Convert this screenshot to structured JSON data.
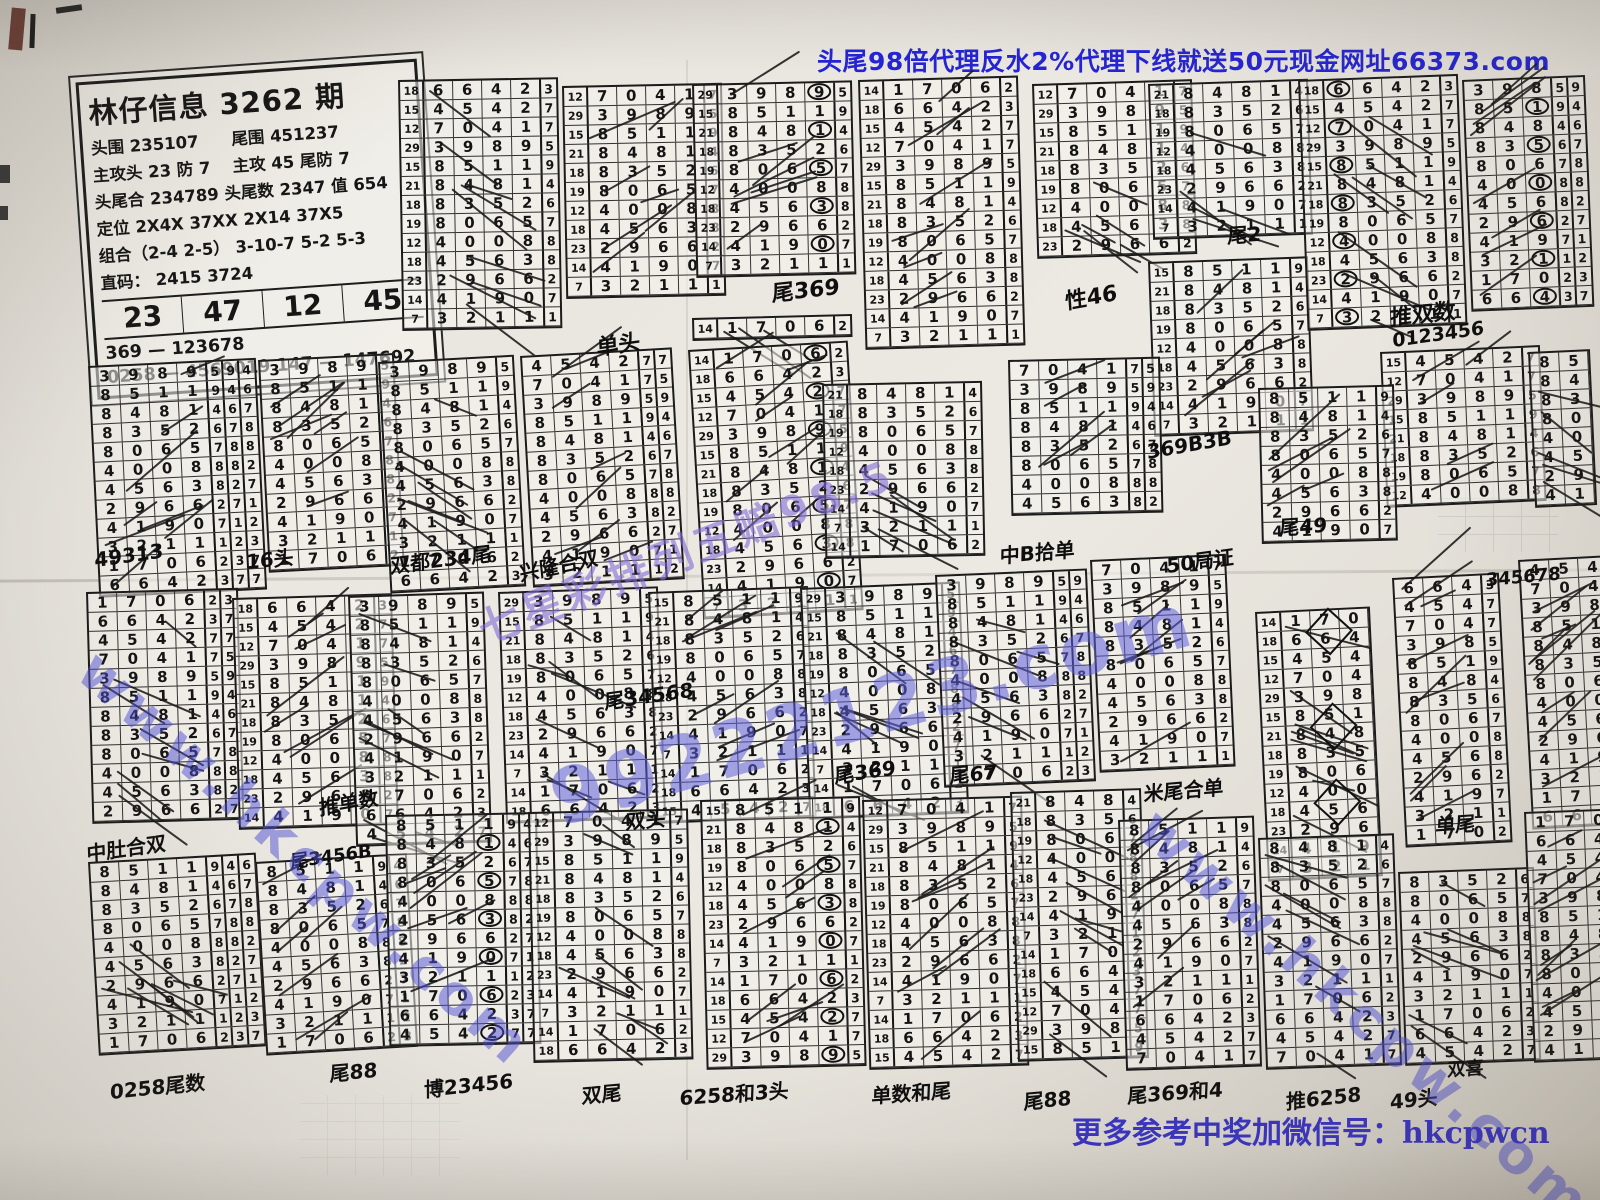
{
  "banner_top": {
    "text": "头尾98倍代理反水2%代理下线就送50元现金网址66373.com",
    "color": "#2424d6"
  },
  "banner_bottom": {
    "text": "更多参考中奖加微信号：hkcpwcn",
    "color": "#3a34c6"
  },
  "info_box": {
    "title": "林仔信息 3262 期",
    "lines": [
      "头围 235107　　尾围 451237",
      "主攻头 23 防 7　 主攻 45 尾防 7",
      "头尾合 234789 头尾数 2347  值 654",
      "定位 2X4X  37XX  2X14  37X5",
      "组合（2-4 2-5）  3-10-7  5-2 5-3",
      "直码： 2415  3724"
    ],
    "highlight_numbers": [
      "23",
      "47",
      "12",
      "45"
    ],
    "footer_lines": [
      "369 — 123678",
      "0258 — 4569019  147 — 147692"
    ]
  },
  "cycle": {
    "labels": [
      "14",
      "18",
      "15",
      "12",
      "29",
      "15",
      "21",
      "18",
      "19",
      "12",
      "18",
      "23",
      "14",
      "7"
    ],
    "digits": [
      "1706",
      "6642",
      "4542",
      "7041",
      "3989",
      "8511",
      "8481",
      "8352",
      "8065",
      "4008",
      "4563",
      "2966",
      "4190",
      "3211"
    ],
    "rights": [
      "2",
      "3",
      "7",
      "7",
      "5",
      "9",
      "4",
      "6",
      "7",
      "8",
      "8",
      "2",
      "7",
      "1"
    ]
  },
  "blocks": [
    {
      "x": 398,
      "y": 80,
      "s": 1,
      "r": 13,
      "lab": 1,
      "c": 4,
      "e": 1
    },
    {
      "x": 562,
      "y": 86,
      "s": 3,
      "r": 11,
      "lab": 1,
      "c": 4,
      "e": 1
    },
    {
      "x": 692,
      "y": 84,
      "s": 4,
      "r": 10,
      "lab": 1,
      "c": 4,
      "e": 1,
      "circle": 3
    },
    {
      "x": 692,
      "y": 318,
      "s": 0,
      "r": 1,
      "lab": 1,
      "c": 4,
      "e": 1
    },
    {
      "x": 858,
      "y": 80,
      "s": 0,
      "r": 14,
      "lab": 1,
      "c": 4,
      "e": 1
    },
    {
      "x": 1032,
      "y": 84,
      "s": 3,
      "r": 9,
      "lab": 1,
      "c": 4,
      "e": 1
    },
    {
      "x": 1148,
      "y": 84,
      "s": 6,
      "r": 8,
      "lab": 1,
      "c": 4,
      "e": 1
    },
    {
      "x": 1148,
      "y": 262,
      "s": 5,
      "r": 9,
      "lab": 1,
      "c": 4,
      "e": 1
    },
    {
      "x": 1298,
      "y": 80,
      "s": 1,
      "r": 13,
      "lab": 1,
      "c": 4,
      "e": 1,
      "circle": 0
    },
    {
      "x": 1462,
      "y": 80,
      "s": 4,
      "r": 12,
      "lab": 0,
      "c": 3,
      "e": 2,
      "circle": 2
    },
    {
      "x": 1380,
      "y": 352,
      "s": 2,
      "r": 8,
      "lab": 1,
      "c": 4,
      "e": 1
    },
    {
      "x": 1528,
      "y": 352,
      "s": 5,
      "r": 8,
      "lab": 0,
      "c": 2,
      "e": 0
    },
    {
      "x": 88,
      "y": 366,
      "s": 4,
      "r": 12,
      "lab": 0,
      "c": 4,
      "e": 3
    },
    {
      "x": 258,
      "y": 360,
      "s": 4,
      "r": 11,
      "lab": 0,
      "c": 4,
      "e": 1
    },
    {
      "x": 378,
      "y": 362,
      "s": 4,
      "r": 12,
      "lab": 0,
      "c": 4,
      "e": 1
    },
    {
      "x": 520,
      "y": 356,
      "s": 2,
      "r": 12,
      "lab": 0,
      "c": 4,
      "e": 2
    },
    {
      "x": 688,
      "y": 350,
      "s": 0,
      "r": 14,
      "lab": 1,
      "c": 4,
      "e": 1,
      "circle": 3
    },
    {
      "x": 822,
      "y": 384,
      "s": 6,
      "r": 9,
      "lab": 1,
      "c": 4,
      "e": 1
    },
    {
      "x": 1008,
      "y": 360,
      "s": 3,
      "r": 8,
      "lab": 0,
      "c": 4,
      "e": 2
    },
    {
      "x": 1258,
      "y": 388,
      "s": 5,
      "r": 8,
      "lab": 0,
      "c": 4,
      "e": 1
    },
    {
      "x": 86,
      "y": 592,
      "s": 0,
      "r": 12,
      "lab": 0,
      "c": 4,
      "e": 2
    },
    {
      "x": 232,
      "y": 598,
      "s": 1,
      "r": 12,
      "lab": 1,
      "c": 4,
      "e": 1
    },
    {
      "x": 348,
      "y": 596,
      "s": 4,
      "r": 13,
      "lab": 0,
      "c": 4,
      "e": 1
    },
    {
      "x": 498,
      "y": 592,
      "s": 4,
      "r": 12,
      "lab": 1,
      "c": 4,
      "e": 1
    },
    {
      "x": 648,
      "y": 592,
      "s": 5,
      "r": 12,
      "lab": 1,
      "c": 4,
      "e": 1
    },
    {
      "x": 800,
      "y": 588,
      "s": 4,
      "r": 12,
      "lab": 1,
      "c": 4,
      "e": 1
    },
    {
      "x": 935,
      "y": 575,
      "s": 4,
      "r": 11,
      "lab": 0,
      "c": 4,
      "e": 2
    },
    {
      "x": 1090,
      "y": 560,
      "s": 3,
      "r": 11,
      "lab": 0,
      "c": 4,
      "e": 1
    },
    {
      "x": 1255,
      "y": 612,
      "s": 0,
      "r": 14,
      "lab": 1,
      "c": 3,
      "e": 0,
      "diamond": 1
    },
    {
      "x": 1392,
      "y": 578,
      "s": 1,
      "r": 14,
      "lab": 0,
      "c": 3,
      "e": 1
    },
    {
      "x": 1518,
      "y": 560,
      "s": 2,
      "r": 14,
      "lab": 0,
      "c": 3,
      "e": 0
    },
    {
      "x": 88,
      "y": 862,
      "s": 5,
      "r": 10,
      "lab": 0,
      "c": 4,
      "e": 3
    },
    {
      "x": 255,
      "y": 862,
      "s": 5,
      "r": 10,
      "lab": 0,
      "c": 4,
      "e": 2
    },
    {
      "x": 385,
      "y": 815,
      "s": 5,
      "r": 12,
      "lab": 0,
      "c": 4,
      "e": 2,
      "circle": 3
    },
    {
      "x": 528,
      "y": 812,
      "s": 3,
      "r": 13,
      "lab": 1,
      "c": 4,
      "e": 1
    },
    {
      "x": 700,
      "y": 800,
      "s": 5,
      "r": 14,
      "lab": 1,
      "c": 4,
      "e": 1,
      "circle": 3
    },
    {
      "x": 862,
      "y": 800,
      "s": 3,
      "r": 14,
      "lab": 1,
      "c": 4,
      "e": 1
    },
    {
      "x": 1010,
      "y": 792,
      "s": 6,
      "r": 14,
      "lab": 1,
      "c": 3,
      "e": 1
    },
    {
      "x": 1118,
      "y": 820,
      "s": 5,
      "r": 13,
      "lab": 0,
      "c": 4,
      "e": 1
    },
    {
      "x": 1258,
      "y": 838,
      "s": 6,
      "r": 12,
      "lab": 0,
      "c": 4,
      "e": 1
    },
    {
      "x": 1398,
      "y": 872,
      "s": 7,
      "r": 10,
      "lab": 0,
      "c": 4,
      "e": 1
    },
    {
      "x": 1524,
      "y": 812,
      "s": 0,
      "r": 13,
      "lab": 0,
      "c": 3,
      "e": 0
    }
  ],
  "notes": [
    {
      "text": "单头",
      "x": 596,
      "y": 330,
      "rot": -8,
      "size": 22
    },
    {
      "text": "尾369",
      "x": 772,
      "y": 276,
      "rot": -6,
      "size": 22
    },
    {
      "text": "性46",
      "x": 1064,
      "y": 284,
      "rot": -10,
      "size": 22
    },
    {
      "text": "尾2",
      "x": 1228,
      "y": 220,
      "rot": -4,
      "size": 20
    },
    {
      "text": "推双数",
      "x": 1390,
      "y": 300,
      "rot": -6,
      "size": 22
    },
    {
      "text": "0123456",
      "x": 1392,
      "y": 330,
      "rot": -8,
      "size": 19
    },
    {
      "text": "369B3B",
      "x": 1146,
      "y": 440,
      "rot": -10,
      "size": 20
    },
    {
      "text": "尾49",
      "x": 1280,
      "y": 512,
      "rot": -4,
      "size": 20
    },
    {
      "text": "49313",
      "x": 94,
      "y": 548,
      "rot": -8,
      "size": 20
    },
    {
      "text": "16头",
      "x": 246,
      "y": 546,
      "rot": -6,
      "size": 20
    },
    {
      "text": "双都234尾",
      "x": 390,
      "y": 550,
      "rot": -7,
      "size": 20
    },
    {
      "text": "兴隆合双",
      "x": 518,
      "y": 558,
      "rot": -12,
      "size": 20
    },
    {
      "text": "中B拾单",
      "x": 1000,
      "y": 540,
      "rot": -5,
      "size": 20
    },
    {
      "text": "50局证",
      "x": 1166,
      "y": 550,
      "rot": -8,
      "size": 20
    },
    {
      "text": "345678",
      "x": 1486,
      "y": 570,
      "rot": -5,
      "size": 18
    },
    {
      "text": "尾34568",
      "x": 604,
      "y": 686,
      "rot": -8,
      "size": 20
    },
    {
      "text": "推单数",
      "x": 318,
      "y": 792,
      "rot": -10,
      "size": 20
    },
    {
      "text": "中肚合双",
      "x": 86,
      "y": 838,
      "rot": -8,
      "size": 20
    },
    {
      "text": "尾3456B",
      "x": 290,
      "y": 848,
      "rot": -8,
      "size": 18
    },
    {
      "text": "双头",
      "x": 626,
      "y": 806,
      "rot": -5,
      "size": 20
    },
    {
      "text": "尾369",
      "x": 834,
      "y": 760,
      "rot": -8,
      "size": 20
    },
    {
      "text": "尾67",
      "x": 950,
      "y": 760,
      "rot": -5,
      "size": 20
    },
    {
      "text": "米尾合单",
      "x": 1144,
      "y": 778,
      "rot": -5,
      "size": 20
    },
    {
      "text": "单尾",
      "x": 1436,
      "y": 810,
      "rot": -4,
      "size": 20
    },
    {
      "text": "0258尾数",
      "x": 110,
      "y": 1076,
      "rot": -6,
      "size": 20
    },
    {
      "text": "尾88",
      "x": 330,
      "y": 1058,
      "rot": -5,
      "size": 20
    },
    {
      "text": "博23456",
      "x": 424,
      "y": 1074,
      "rot": -6,
      "size": 20
    },
    {
      "text": "双尾",
      "x": 582,
      "y": 1080,
      "rot": -5,
      "size": 20
    },
    {
      "text": "6258和3头",
      "x": 680,
      "y": 1082,
      "rot": -4,
      "size": 20
    },
    {
      "text": "单数和尾",
      "x": 872,
      "y": 1080,
      "rot": -4,
      "size": 20
    },
    {
      "text": "尾88",
      "x": 1024,
      "y": 1086,
      "rot": -5,
      "size": 20
    },
    {
      "text": "尾369和4",
      "x": 1128,
      "y": 1080,
      "rot": -4,
      "size": 20
    },
    {
      "text": "推6258",
      "x": 1286,
      "y": 1086,
      "rot": -6,
      "size": 20
    },
    {
      "text": "49头",
      "x": 1390,
      "y": 1086,
      "rot": -6,
      "size": 20
    },
    {
      "text": "双喜",
      "x": 1448,
      "y": 1056,
      "rot": -4,
      "size": 18
    }
  ],
  "watermarks": [
    {
      "text": "七星彩排列五赔98.5",
      "x": 468,
      "y": 600,
      "rot": -21,
      "size": 42,
      "color": "rgba(128,106,214,0.60)",
      "spacing": 4
    },
    {
      "text": "99222123.com",
      "x": 540,
      "y": 758,
      "rot": -16,
      "size": 76,
      "color": "rgba(94,94,218,0.55)",
      "spacing": 3
    },
    {
      "text": "www.hkcpw.com",
      "x": 108,
      "y": 638,
      "rot": 42,
      "size": 56,
      "color": "rgba(78,78,214,0.50),",
      "spacing": 5
    },
    {
      "text": "www.hkcpw.com",
      "x": 1168,
      "y": 796,
      "rot": 42,
      "size": 56,
      "color": "rgba(78,78,214,0.50)",
      "spacing": 5
    }
  ],
  "side_text": "C5000V08"
}
